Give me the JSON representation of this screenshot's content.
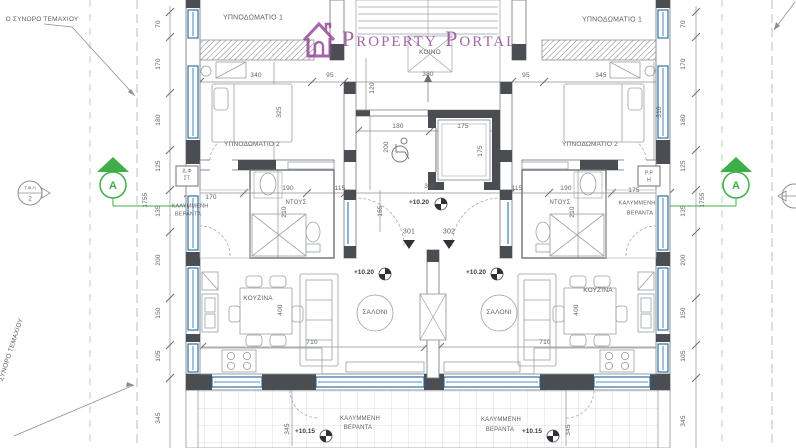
{
  "watermark": {
    "text": "Property Portal",
    "color": "#8e4191"
  },
  "section_marker": {
    "letter": "A",
    "color": "#3fae49"
  },
  "detail_marker": {
    "top": "Τ.Φ.Η",
    "bottom": "2"
  },
  "colors": {
    "accent_blue": "#1b64a0",
    "wall_dark": "#4a4d52",
    "section_green": "#3fae49",
    "watermark_purple": "#8e4191"
  },
  "annotations": [
    {
      "n": "room-label-bedroom1-left",
      "t": "ΥΠΝΟΔΩΜΑΤΙΟ 1",
      "x": 253,
      "y": 18,
      "s": 7
    },
    {
      "n": "room-label-bedroom1-right",
      "t": "ΥΠΝΟΔΩΜΑΤΙΟ 1",
      "x": 612,
      "y": 20,
      "s": 7
    },
    {
      "n": "room-label-bedroom2-left",
      "t": "ΥΠΝΟΔΩΜΑΤΙΟ 2",
      "x": 252,
      "y": 145,
      "s": 6.5
    },
    {
      "n": "room-label-bedroom2-right",
      "t": "ΥΠΝΟΔΩΜΑΤΙΟ 2",
      "x": 590,
      "y": 145,
      "s": 6.5
    },
    {
      "n": "room-label-common",
      "t": "ΚΟΙΝΟ",
      "x": 430,
      "y": 53,
      "s": 6.5
    },
    {
      "n": "room-label-shower-left",
      "t": "ΝΤΟΥΣ",
      "x": 296,
      "y": 203,
      "s": 6
    },
    {
      "n": "room-label-shower-right",
      "t": "ΝΤΟΥΣ",
      "x": 560,
      "y": 203,
      "s": 6
    },
    {
      "n": "room-label-veranda-left-1",
      "t": "ΚΑΛΥΜΜΕΝΗ",
      "x": 190,
      "y": 207,
      "s": 5.5
    },
    {
      "n": "room-label-veranda-left-2",
      "t": "ΒΕΡΑΝΤΑ",
      "x": 188,
      "y": 215,
      "s": 5.5
    },
    {
      "n": "room-label-veranda-right-1",
      "t": "ΚΑΛΥΜΜΕΝΗ",
      "x": 637,
      "y": 204,
      "s": 5.5
    },
    {
      "n": "room-label-veranda-right-2",
      "t": "ΒΕΡΑΝΤΑ",
      "x": 640,
      "y": 214,
      "s": 5.5
    },
    {
      "n": "room-label-kitchen-left",
      "t": "ΚΟΥΖΙΝΑ",
      "x": 258,
      "y": 299,
      "s": 6.5
    },
    {
      "n": "room-label-kitchen-right",
      "t": "ΚΟΥΖΙΝΑ",
      "x": 598,
      "y": 291,
      "s": 6.5
    },
    {
      "n": "room-label-living-left",
      "t": "ΣΑΛΟΝΙ",
      "x": 375,
      "y": 313,
      "s": 6.5
    },
    {
      "n": "room-label-living-right",
      "t": "ΣΑΛΟΝΙ",
      "x": 499,
      "y": 313,
      "s": 6.5
    },
    {
      "n": "room-label-veranda-bottom-left-1",
      "t": "ΚΑΛΥΜΜΕΝΗ",
      "x": 360,
      "y": 419,
      "s": 6
    },
    {
      "n": "room-label-veranda-bottom-left-2",
      "t": "ΒΕΡΑΝΤΑ",
      "x": 358,
      "y": 428,
      "s": 6
    },
    {
      "n": "room-label-veranda-bottom-right-1",
      "t": "ΚΑΛΥΜΜΕΝΗ",
      "x": 501,
      "y": 420,
      "s": 6
    },
    {
      "n": "room-label-veranda-bottom-right-2",
      "t": "ΒΕΡΑΝΤΑ",
      "x": 500,
      "y": 430,
      "s": 6
    },
    {
      "n": "shaft-label-left-1",
      "t": "Δ.Φ",
      "x": 187,
      "y": 172,
      "s": 5
    },
    {
      "n": "shaft-label-left-2",
      "t": "ΣΤ",
      "x": 187,
      "y": 179,
      "s": 5
    },
    {
      "n": "shaft-label-right-1",
      "t": "Ρ.Ρ",
      "x": 649,
      "y": 174,
      "s": 5
    },
    {
      "n": "shaft-label-right-2",
      "t": "Η",
      "x": 649,
      "y": 181,
      "s": 5
    },
    {
      "n": "apartment-number-301",
      "t": "301",
      "x": 409,
      "y": 232,
      "s": 7
    },
    {
      "n": "apartment-number-302",
      "t": "302",
      "x": 449,
      "y": 232,
      "s": 7
    },
    {
      "n": "level-entrance",
      "t": "+10.20",
      "x": 419,
      "y": 203,
      "s": 6.5,
      "c": "lvl"
    },
    {
      "n": "level-living-left",
      "t": "+10.20",
      "x": 364,
      "y": 273,
      "s": 6.5,
      "c": "lvl"
    },
    {
      "n": "level-living-right",
      "t": "+10.20",
      "x": 476,
      "y": 273,
      "s": 6.5,
      "c": "lvl"
    },
    {
      "n": "level-veranda-left",
      "t": "+10.15",
      "x": 305,
      "y": 432,
      "s": 6.5,
      "c": "lvl"
    },
    {
      "n": "level-veranda-right",
      "t": "+10.15",
      "x": 532,
      "y": 432,
      "s": 6.5,
      "c": "lvl"
    },
    {
      "n": "plot-boundary-label-top",
      "t": "Ο ΣΥΝΟΡΟ ΤΕΜΑΧΙΟΥ",
      "x": 42,
      "y": 20,
      "s": 6.5
    },
    {
      "n": "plot-boundary-label-left",
      "t": "ΣΥΝΟΡΟ ΤΕΜΑΧΙΟΥ",
      "x": 12,
      "y": 350,
      "r": -72,
      "s": 6.5
    },
    {
      "n": "dim-label",
      "t": "70",
      "x": 159,
      "y": 24,
      "r": -90,
      "s": 6.5
    },
    {
      "n": "dim-label",
      "t": "170",
      "x": 159,
      "y": 64,
      "r": -90,
      "s": 6.5
    },
    {
      "n": "dim-label",
      "t": "180",
      "x": 159,
      "y": 120,
      "r": -90,
      "s": 6.5
    },
    {
      "n": "dim-label",
      "t": "125",
      "x": 159,
      "y": 166,
      "r": -90,
      "s": 6.5
    },
    {
      "n": "dim-label",
      "t": "135",
      "x": 159,
      "y": 211,
      "r": -90,
      "s": 6.5
    },
    {
      "n": "dim-label",
      "t": "200",
      "x": 159,
      "y": 260,
      "r": -90,
      "s": 6.5
    },
    {
      "n": "dim-label",
      "t": "150",
      "x": 159,
      "y": 313,
      "r": -90,
      "s": 6.5
    },
    {
      "n": "dim-label",
      "t": "105",
      "x": 159,
      "y": 356,
      "r": -90,
      "s": 6.5
    },
    {
      "n": "dim-label",
      "t": "345",
      "x": 159,
      "y": 418,
      "r": -90,
      "s": 6.5
    },
    {
      "n": "dim-total",
      "t": "1755",
      "x": 146,
      "y": 200,
      "r": -90,
      "s": 6.5
    },
    {
      "n": "dim-label",
      "t": "70",
      "x": 684,
      "y": 24,
      "r": -90,
      "s": 6.5
    },
    {
      "n": "dim-label",
      "t": "170",
      "x": 684,
      "y": 64,
      "r": -90,
      "s": 6.5
    },
    {
      "n": "dim-label",
      "t": "180",
      "x": 684,
      "y": 120,
      "r": -90,
      "s": 6.5
    },
    {
      "n": "dim-label",
      "t": "125",
      "x": 684,
      "y": 166,
      "r": -90,
      "s": 6.5
    },
    {
      "n": "dim-label",
      "t": "135",
      "x": 684,
      "y": 211,
      "r": -90,
      "s": 6.5
    },
    {
      "n": "dim-label",
      "t": "200",
      "x": 684,
      "y": 260,
      "r": -90,
      "s": 6.5
    },
    {
      "n": "dim-label",
      "t": "150",
      "x": 684,
      "y": 313,
      "r": -90,
      "s": 6.5
    },
    {
      "n": "dim-label",
      "t": "105",
      "x": 684,
      "y": 356,
      "r": -90,
      "s": 6.5
    },
    {
      "n": "dim-label",
      "t": "345",
      "x": 684,
      "y": 421,
      "r": -90,
      "s": 6.5
    },
    {
      "n": "dim-total",
      "t": "1755",
      "x": 703,
      "y": 200,
      "r": -90,
      "s": 6.5
    },
    {
      "n": "dim-label",
      "t": "340",
      "x": 256,
      "y": 76,
      "s": 6.5
    },
    {
      "n": "dim-label",
      "t": "95",
      "x": 330,
      "y": 76,
      "s": 6.5
    },
    {
      "n": "dim-label",
      "t": "380",
      "x": 428,
      "y": 75,
      "s": 6.5
    },
    {
      "n": "dim-label",
      "t": "95",
      "x": 526,
      "y": 76,
      "s": 6.5
    },
    {
      "n": "dim-label",
      "t": "345",
      "x": 601,
      "y": 76,
      "s": 6.5
    },
    {
      "n": "dim-label",
      "t": "170",
      "x": 211,
      "y": 198,
      "s": 6.5
    },
    {
      "n": "dim-label",
      "t": "190",
      "x": 288,
      "y": 189,
      "s": 6.5
    },
    {
      "n": "dim-label",
      "t": "115",
      "x": 340,
      "y": 189,
      "s": 6.5
    },
    {
      "n": "dim-label",
      "t": "380",
      "x": 430,
      "y": 187,
      "s": 6.5
    },
    {
      "n": "dim-label",
      "t": "115",
      "x": 517,
      "y": 189,
      "s": 6.5
    },
    {
      "n": "dim-label",
      "t": "190",
      "x": 566,
      "y": 189,
      "s": 6.5
    },
    {
      "n": "dim-label",
      "t": "175",
      "x": 634,
      "y": 191,
      "s": 6.5
    },
    {
      "n": "dim-label",
      "t": "180",
      "x": 398,
      "y": 127,
      "s": 6.5
    },
    {
      "n": "dim-label",
      "t": "175",
      "x": 463,
      "y": 127,
      "s": 6.5
    },
    {
      "n": "dim-label",
      "t": "710",
      "x": 312,
      "y": 343,
      "s": 6.5
    },
    {
      "n": "dim-label",
      "t": "710",
      "x": 545,
      "y": 343,
      "s": 6.5
    },
    {
      "n": "dim-label",
      "t": "120",
      "x": 373,
      "y": 88,
      "r": -90,
      "s": 6.5
    },
    {
      "n": "dim-label",
      "t": "200",
      "x": 387,
      "y": 147,
      "r": -90,
      "s": 6.5
    },
    {
      "n": "dim-label",
      "t": "175",
      "x": 481,
      "y": 151,
      "r": -90,
      "s": 6.5
    },
    {
      "n": "dim-label",
      "t": "155",
      "x": 381,
      "y": 211,
      "r": -90,
      "s": 6.5
    },
    {
      "n": "dim-label",
      "t": "325",
      "x": 280,
      "y": 112,
      "r": -90,
      "s": 6.5
    },
    {
      "n": "dim-label",
      "t": "310",
      "x": 660,
      "y": 112,
      "r": -90,
      "s": 6.5
    },
    {
      "n": "dim-label",
      "t": "210",
      "x": 285,
      "y": 212,
      "r": -90,
      "s": 6.5
    },
    {
      "n": "dim-label",
      "t": "210",
      "x": 573,
      "y": 212,
      "r": -90,
      "s": 6.5
    },
    {
      "n": "dim-label",
      "t": "400",
      "x": 281,
      "y": 310,
      "r": -90,
      "s": 6.5
    },
    {
      "n": "dim-label",
      "t": "400",
      "x": 577,
      "y": 310,
      "r": -90,
      "s": 6.5
    },
    {
      "n": "dim-label",
      "t": "345",
      "x": 288,
      "y": 429,
      "r": -90,
      "s": 6.5
    },
    {
      "n": "dim-label",
      "t": "345",
      "x": 569,
      "y": 430,
      "r": -90,
      "s": 6.5
    }
  ]
}
